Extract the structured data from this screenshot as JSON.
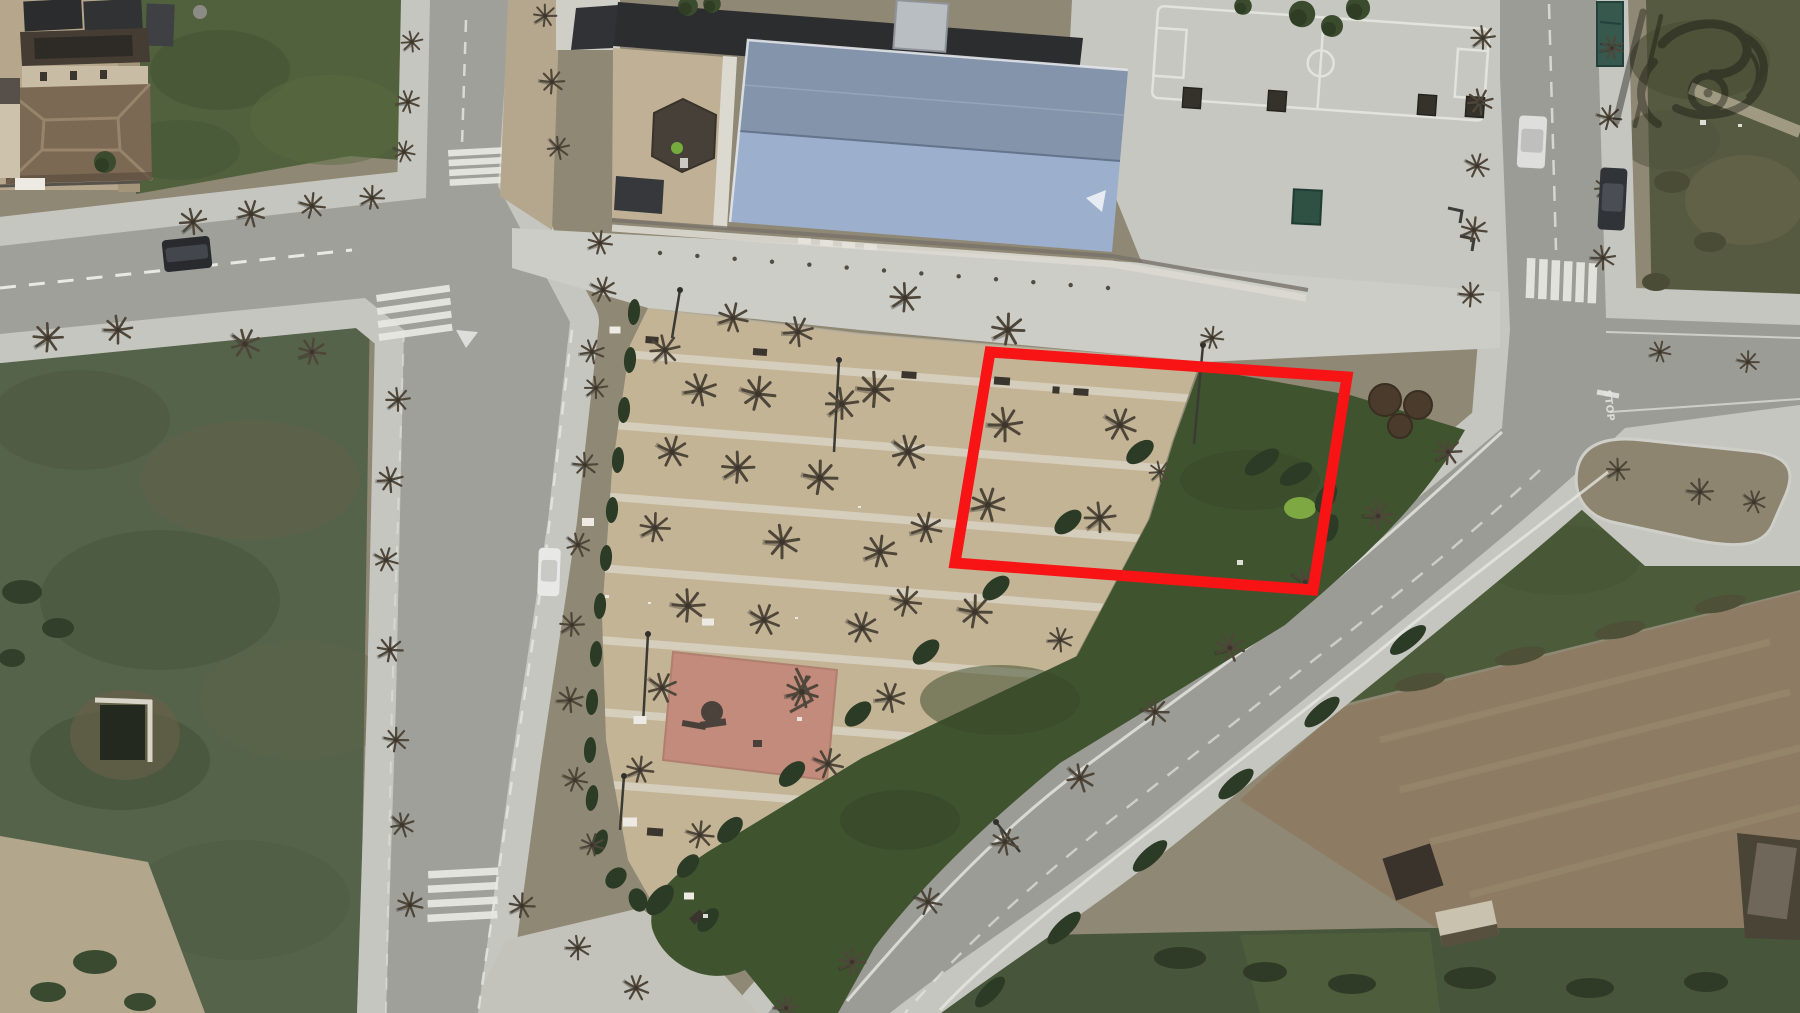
{
  "scene": {
    "description": "Aerial satellite view of a small town block: school building with large blue gable roof and basketball court at top, triangular tan plaza with leafless plane trees, pink playground square, dark green lawn wedge, surrounding streets with zebra crossings, scrub and plowed fields, and a red rectangular highlight annotation over part of the plaza.",
    "width": 1800,
    "height": 1013
  },
  "palette": {
    "asphalt": "#a0a09b",
    "sidewalk": "#c6c6c0",
    "forecourt": "#cdcdc7",
    "plaza": "#c3b496",
    "plaza_path": "#d8d1c1",
    "grass_wedge": "#40532f",
    "hedge": "#2c3b26",
    "bright_bush": "#7da842",
    "scrub_field": "#55634a",
    "grass_field": "#51613d",
    "dirt_field": "#8d7c63",
    "roof_dark": "#2b2d2f",
    "roof_blue_upper": "#8494ab",
    "roof_blue_lower": "#9cafcc",
    "roof_brown": "#7b6954",
    "playground": "#c28b7c",
    "annotation_red": "#f81414",
    "white_marking": "#e9e9e4",
    "tree_branch": "#4f463a"
  },
  "annotation": {
    "label": "highlighted-parcel-rectangle",
    "color": "#f81414",
    "stroke_width": 11,
    "points": "990,352 1347,377 1313,590 955,563"
  },
  "road_markings": {
    "stop": "STOP"
  },
  "watermark": {
    "opacity": 0.4
  },
  "features": {
    "trees": [
      [
        193,
        222,
        1,
        0
      ],
      [
        251,
        214,
        1,
        30
      ],
      [
        312,
        206,
        0.95,
        60
      ],
      [
        372,
        198,
        0.9,
        15
      ],
      [
        48,
        338,
        1.1,
        10
      ],
      [
        118,
        330,
        1.05,
        45
      ],
      [
        245,
        344,
        1.1,
        80
      ],
      [
        312,
        352,
        1,
        20
      ],
      [
        412,
        42,
        0.8,
        0
      ],
      [
        408,
        102,
        0.85,
        33
      ],
      [
        404,
        152,
        0.8,
        66
      ],
      [
        545,
        16,
        0.85,
        12
      ],
      [
        552,
        82,
        0.9,
        50
      ],
      [
        558,
        148,
        0.85,
        90
      ],
      [
        398,
        400,
        0.9,
        5
      ],
      [
        390,
        480,
        0.95,
        40
      ],
      [
        386,
        560,
        0.9,
        70
      ],
      [
        390,
        650,
        0.95,
        15
      ],
      [
        396,
        740,
        0.9,
        55
      ],
      [
        402,
        825,
        0.9,
        85
      ],
      [
        410,
        905,
        0.95,
        25
      ],
      [
        600,
        243,
        0.9,
        20
      ],
      [
        603,
        290,
        0.95,
        70
      ],
      [
        592,
        352,
        0.9,
        35
      ],
      [
        596,
        388,
        0.85,
        5
      ],
      [
        585,
        465,
        0.9,
        50
      ],
      [
        578,
        545,
        0.9,
        80
      ],
      [
        572,
        625,
        0.9,
        10
      ],
      [
        570,
        700,
        0.95,
        40
      ],
      [
        575,
        780,
        0.9,
        65
      ],
      [
        592,
        845,
        0.85,
        30
      ],
      [
        665,
        350,
        1.1,
        0
      ],
      [
        700,
        390,
        1.2,
        35
      ],
      [
        672,
        452,
        1.15,
        70
      ],
      [
        655,
        528,
        1.1,
        15
      ],
      [
        688,
        606,
        1.2,
        50
      ],
      [
        662,
        688,
        1.1,
        80
      ],
      [
        640,
        770,
        1,
        20
      ],
      [
        700,
        835,
        1,
        60
      ],
      [
        733,
        318,
        1.1,
        25
      ],
      [
        758,
        394,
        1.25,
        60
      ],
      [
        738,
        468,
        1.2,
        10
      ],
      [
        782,
        542,
        1.25,
        45
      ],
      [
        764,
        620,
        1.15,
        75
      ],
      [
        802,
        692,
        1.2,
        30
      ],
      [
        828,
        764,
        1.1,
        65
      ],
      [
        798,
        332,
        1.1,
        40
      ],
      [
        842,
        404,
        1.2,
        5
      ],
      [
        820,
        478,
        1.25,
        55
      ],
      [
        880,
        552,
        1.2,
        20
      ],
      [
        862,
        628,
        1.15,
        70
      ],
      [
        890,
        698,
        1.1,
        35
      ],
      [
        905,
        298,
        1.1,
        10
      ],
      [
        875,
        390,
        1.3,
        50
      ],
      [
        908,
        452,
        1.25,
        80
      ],
      [
        926,
        528,
        1.15,
        25
      ],
      [
        906,
        602,
        1.1,
        60
      ],
      [
        1008,
        330,
        1.2,
        15
      ],
      [
        1005,
        425,
        1.25,
        45
      ],
      [
        1120,
        425,
        1.2,
        75
      ],
      [
        988,
        505,
        1.25,
        30
      ],
      [
        1100,
        518,
        1.15,
        5
      ],
      [
        975,
        612,
        1.2,
        55
      ],
      [
        1160,
        472,
        0.8,
        0
      ],
      [
        1060,
        640,
        0.9,
        40
      ],
      [
        1212,
        338,
        0.85,
        20
      ],
      [
        1448,
        452,
        1,
        10
      ],
      [
        1378,
        516,
        1.05,
        45
      ],
      [
        1305,
        582,
        1,
        75
      ],
      [
        1230,
        648,
        1.05,
        25
      ],
      [
        1155,
        712,
        1,
        55
      ],
      [
        1080,
        778,
        1.05,
        85
      ],
      [
        1005,
        842,
        1,
        35
      ],
      [
        928,
        902,
        1,
        65
      ],
      [
        852,
        962,
        1,
        15
      ],
      [
        786,
        1008,
        0.9,
        45
      ],
      [
        1483,
        38,
        0.9,
        5
      ],
      [
        1480,
        102,
        0.95,
        40
      ],
      [
        1477,
        166,
        0.9,
        70
      ],
      [
        1474,
        230,
        0.95,
        20
      ],
      [
        1471,
        295,
        0.9,
        50
      ],
      [
        1612,
        48,
        0.85,
        30
      ],
      [
        1609,
        118,
        0.9,
        60
      ],
      [
        1606,
        188,
        0.85,
        0
      ],
      [
        1603,
        258,
        0.9,
        45
      ],
      [
        1618,
        470,
        0.85,
        10
      ],
      [
        1700,
        492,
        0.95,
        50
      ],
      [
        1754,
        502,
        0.85,
        80
      ],
      [
        1660,
        352,
        0.8,
        25
      ],
      [
        1748,
        362,
        0.8,
        55
      ],
      [
        522,
        906,
        0.95,
        15
      ],
      [
        578,
        948,
        0.9,
        45
      ],
      [
        636,
        988,
        0.95,
        75
      ]
    ],
    "green_trees": [
      [
        1302,
        14,
        1.2
      ],
      [
        1332,
        26,
        1
      ],
      [
        1358,
        8,
        1.1
      ],
      [
        1243,
        6,
        0.8
      ],
      [
        105,
        162,
        1
      ],
      [
        688,
        6,
        0.9
      ],
      [
        712,
        4,
        0.8
      ]
    ],
    "hedges": [
      [
        1140,
        452,
        16,
        9,
        -38,
        ""
      ],
      [
        1068,
        522,
        16,
        9,
        -40,
        ""
      ],
      [
        996,
        588,
        16,
        9,
        -40,
        ""
      ],
      [
        926,
        652,
        16,
        9,
        -42,
        ""
      ],
      [
        858,
        714,
        16,
        9,
        -42,
        ""
      ],
      [
        792,
        774,
        16,
        9,
        -44,
        ""
      ],
      [
        730,
        830,
        16,
        9,
        -46,
        ""
      ],
      [
        688,
        866,
        14,
        8,
        -48,
        ""
      ],
      [
        660,
        900,
        18,
        10,
        -50,
        ""
      ],
      [
        708,
        920,
        14,
        8,
        -50,
        ""
      ],
      [
        1262,
        462,
        20,
        9,
        -35,
        ""
      ],
      [
        1296,
        474,
        18,
        9,
        -30,
        ""
      ],
      [
        1326,
        498,
        16,
        9,
        -60,
        ""
      ],
      [
        1330,
        528,
        14,
        8,
        -75,
        ""
      ],
      [
        1408,
        640,
        22,
        8,
        -38,
        ""
      ],
      [
        1322,
        712,
        22,
        8,
        -40,
        ""
      ],
      [
        1236,
        784,
        22,
        8,
        -40,
        ""
      ],
      [
        1150,
        856,
        22,
        8,
        -42,
        ""
      ],
      [
        1064,
        928,
        22,
        8,
        -44,
        ""
      ],
      [
        990,
        992,
        20,
        8,
        -46,
        ""
      ],
      [
        634,
        312,
        6,
        13,
        4,
        ""
      ],
      [
        630,
        360,
        6,
        13,
        4,
        ""
      ],
      [
        624,
        410,
        6,
        13,
        4,
        ""
      ],
      [
        618,
        460,
        6,
        13,
        4,
        ""
      ],
      [
        612,
        510,
        6,
        13,
        4,
        ""
      ],
      [
        606,
        558,
        6,
        13,
        4,
        ""
      ],
      [
        600,
        606,
        6,
        13,
        4,
        ""
      ],
      [
        596,
        654,
        6,
        13,
        4,
        ""
      ],
      [
        592,
        702,
        6,
        13,
        4,
        ""
      ],
      [
        590,
        750,
        6,
        13,
        4,
        ""
      ],
      [
        592,
        798,
        6,
        13,
        8,
        ""
      ],
      [
        600,
        842,
        7,
        13,
        20,
        ""
      ],
      [
        616,
        878,
        9,
        12,
        45,
        ""
      ],
      [
        638,
        900,
        12,
        9,
        70,
        ""
      ],
      [
        22,
        592,
        20,
        12,
        0,
        "#32402b"
      ],
      [
        58,
        628,
        16,
        10,
        0,
        "#32402b"
      ],
      [
        12,
        658,
        13,
        9,
        0,
        "#32402b"
      ],
      [
        95,
        962,
        22,
        12,
        0,
        "#3a4a30"
      ],
      [
        48,
        992,
        18,
        10,
        0,
        "#3a4a30"
      ],
      [
        140,
        1002,
        16,
        9,
        0,
        "#3a4a30"
      ],
      [
        1672,
        182,
        18,
        11,
        0,
        "#4a4c36"
      ],
      [
        1710,
        242,
        16,
        10,
        0,
        "#4a4c36"
      ],
      [
        1656,
        282,
        14,
        9,
        0,
        "#4a4c36"
      ],
      [
        1180,
        958,
        26,
        11,
        0,
        "#2f3b26"
      ],
      [
        1265,
        972,
        22,
        10,
        0,
        "#2f3b26"
      ],
      [
        1352,
        984,
        24,
        10,
        0,
        "#2f3b26"
      ],
      [
        1470,
        978,
        26,
        11,
        0,
        "#2f3b26"
      ],
      [
        1590,
        988,
        24,
        10,
        0,
        "#2f3b26"
      ],
      [
        1706,
        982,
        22,
        10,
        0,
        "#2f3b26"
      ],
      [
        1420,
        682,
        26,
        8,
        -12,
        "#4e5038"
      ],
      [
        1520,
        656,
        26,
        8,
        -12,
        "#4e5038"
      ],
      [
        1620,
        630,
        26,
        8,
        -12,
        "#4e5038"
      ],
      [
        1720,
        604,
        26,
        8,
        -12,
        "#4e5038"
      ]
    ],
    "bushes_brown": [
      [
        1385,
        400,
        16
      ],
      [
        1418,
        405,
        14
      ],
      [
        1400,
        426,
        12
      ]
    ],
    "benches": [
      [
        909,
        375,
        15,
        7,
        4
      ],
      [
        1002,
        381,
        16,
        8,
        4
      ],
      [
        1081,
        392,
        15,
        7,
        4
      ],
      [
        760,
        352,
        14,
        7,
        4
      ],
      [
        652,
        340,
        13,
        7,
        4
      ],
      [
        655,
        832,
        16,
        8,
        4
      ],
      [
        697,
        917,
        14,
        8,
        -40
      ],
      [
        1056,
        390,
        7,
        7,
        4
      ]
    ],
    "white_objects": [
      [
        588,
        522,
        12,
        8
      ],
      [
        640,
        720,
        13,
        8
      ],
      [
        708,
        622,
        12,
        7
      ],
      [
        630,
        822,
        14,
        9
      ],
      [
        689,
        896,
        10,
        7
      ],
      [
        615,
        330,
        11,
        7
      ],
      [
        30,
        184,
        30,
        12
      ]
    ],
    "specks": [
      [
        605,
        595,
        4
      ],
      [
        648,
        602,
        3
      ],
      [
        795,
        617,
        3
      ],
      [
        1237,
        560,
        6
      ],
      [
        858,
        506,
        3
      ],
      [
        1700,
        120,
        6
      ],
      [
        1738,
        124,
        4
      ],
      [
        703,
        914,
        5
      ],
      [
        797,
        717,
        5
      ]
    ],
    "lamps": [
      [
        1203,
        345,
        1194,
        444
      ],
      [
        839,
        360,
        834,
        452
      ],
      [
        648,
        634,
        643,
        724
      ],
      [
        680,
        290,
        672,
        338
      ],
      [
        624,
        776,
        620,
        830
      ],
      [
        996,
        822,
        1020,
        852
      ]
    ],
    "cars": [
      {
        "x": 163,
        "y": 238,
        "w": 48,
        "h": 32,
        "r": -6,
        "body": "#282a2e",
        "top": "#43464c"
      },
      {
        "x": 538,
        "y": 548,
        "w": 22,
        "h": 48,
        "r": 2,
        "body": "#e8e8e6",
        "top": "#c9c9c6"
      },
      {
        "x": 1518,
        "y": 116,
        "w": 28,
        "h": 52,
        "r": 3,
        "body": "#dededd",
        "top": "#bfbfbd"
      },
      {
        "x": 1599,
        "y": 168,
        "w": 27,
        "h": 62,
        "r": 3,
        "body": "#303338",
        "top": "#4a4e54"
      }
    ],
    "crosswalks": [
      {
        "x": 448,
        "y": 150,
        "bw": 56,
        "bh": 6.5,
        "n": 4,
        "dx": 0,
        "dy": 9.8,
        "rot": -3
      },
      {
        "x": 376,
        "y": 295,
        "bw": 74,
        "bh": 7,
        "n": 4,
        "dx": -1,
        "dy": 13,
        "rot": -8
      },
      {
        "x": 428,
        "y": 871,
        "bw": 70,
        "bh": 7.5,
        "n": 4,
        "dx": -1,
        "dy": 14.5,
        "rot": -3
      },
      {
        "x": 1527,
        "y": 258,
        "bw": 8.5,
        "bh": 40,
        "n": 6,
        "dx": 12.4,
        "dy": 0.6,
        "rot": 2
      }
    ],
    "bollards": {
      "x1": 660,
      "y1": 253,
      "x2": 1108,
      "y2": 288,
      "n": 13
    }
  }
}
